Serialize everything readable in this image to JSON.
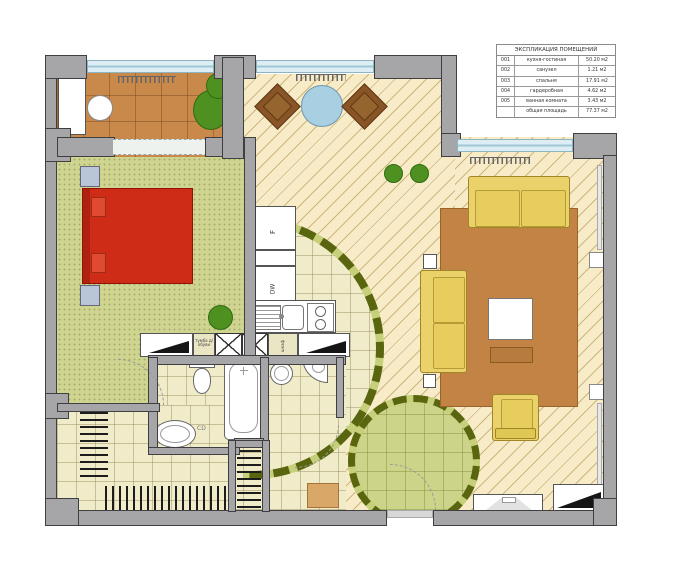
{
  "legend": {
    "title": "ЭКСПЛИКАЦИЯ ПОМЕЩЕНИЙ",
    "rows": [
      {
        "num": "001",
        "name": "кухня-гостиная",
        "area": "50.20 м2"
      },
      {
        "num": "002",
        "name": "санузел",
        "area": "1.21 м2"
      },
      {
        "num": "003",
        "name": "спальня",
        "area": "17.91 м2"
      },
      {
        "num": "004",
        "name": "гардеробная",
        "area": "4.62 м2"
      },
      {
        "num": "005",
        "name": "ванная комната",
        "area": "3.43 м2"
      },
      {
        "num": "",
        "name": "общая площадь",
        "area": "77.37 м2"
      }
    ]
  },
  "appliance_labels": {
    "fridge": "F",
    "dishwasher": "DW",
    "bath_marker": "CD"
  },
  "furniture_labels": {
    "shoe_cabinet": "тумба д/обуви",
    "wardrobe": "шкаф"
  },
  "colors": {
    "wall": "#a6a6a8",
    "bed": "#ce2c16",
    "sofa": "#ead169",
    "rug": "#c28345",
    "balcony_floor": "#c9894a",
    "bedroom_floor": "#cfd491",
    "parquet": "#f8ecc8",
    "tile": "#f0ecc9",
    "plant_green": "#4f9120",
    "zone_band_olive": "#5a660f",
    "glazing": "#dceef4",
    "chair_brown": "#8a5526",
    "dining_table_blue": "#a9cfe3"
  }
}
